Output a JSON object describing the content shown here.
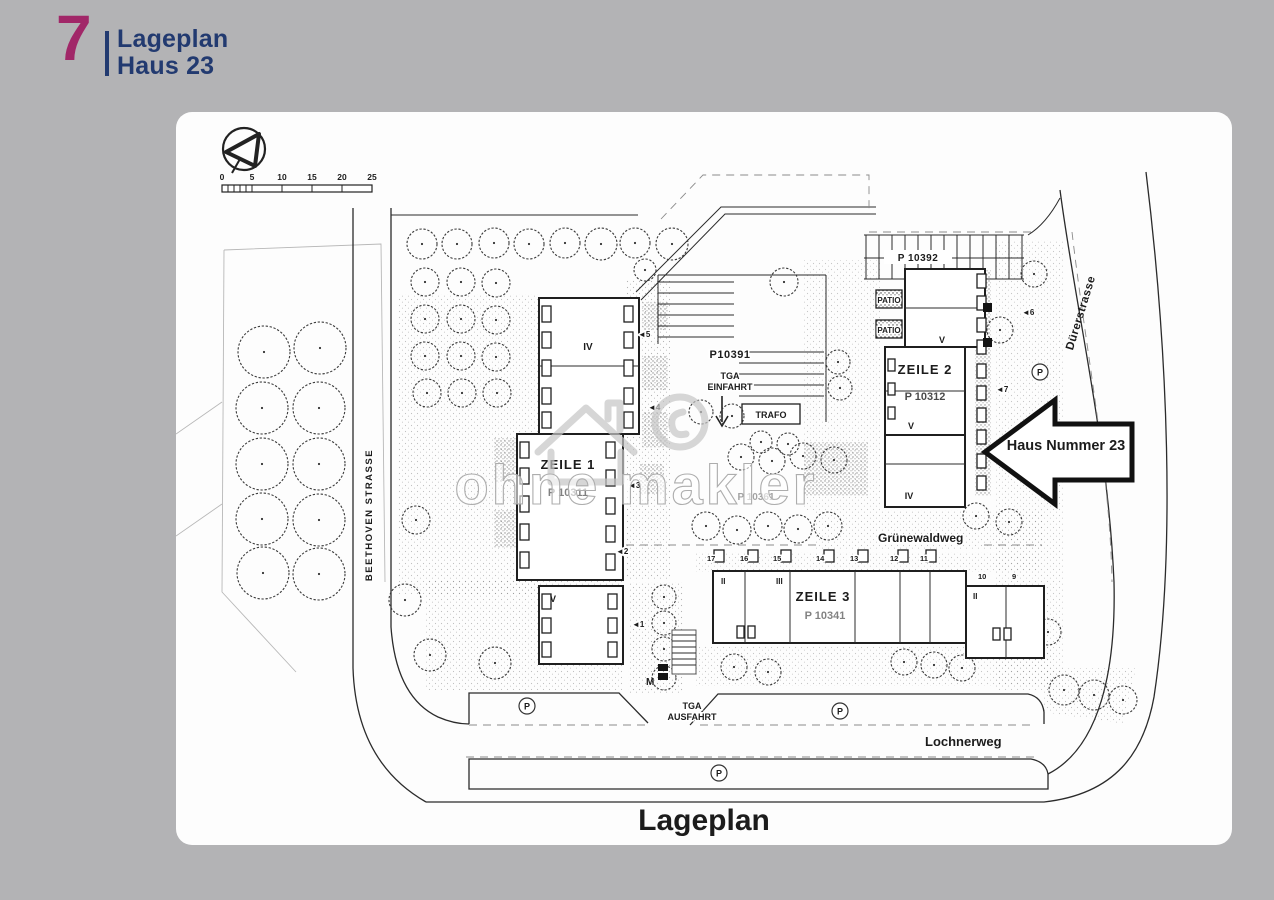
{
  "page": {
    "background": "#b3b3b5",
    "card_background": "#fdfdfd"
  },
  "header": {
    "number": "7",
    "title_line1": "Lageplan",
    "title_line2": "Haus 23",
    "number_color": "#a12768",
    "title_color": "#223a70"
  },
  "plan": {
    "caption": "Lageplan",
    "watermark_text": "ohne makler",
    "arrow_label": "Haus Nummer 23",
    "scale_ticks": [
      "0",
      "5",
      "10",
      "15",
      "20",
      "25"
    ],
    "streets": {
      "left": "BEETHOVEN STRASSE",
      "right": "Dürerstrasse",
      "bottom": "Lochnerweg",
      "inner": "Grünewaldweg"
    },
    "buildings": {
      "zeile1": "ZEILE 1",
      "zeile1_parcel": "P 10311",
      "zeile2": "ZEILE 2",
      "zeile2_parcel": "P 10312",
      "zeile3": "ZEILE 3",
      "zeile3_parcel": "P 10341"
    },
    "parcels": {
      "p10391": "P10391",
      "p10392": "P 10392",
      "p10361": "P 10361"
    },
    "labels": {
      "trafo": "TRAFO",
      "tga": "TGA",
      "einfahrt": "EINFAHRT",
      "ausfahrt": "AUSFAHRT",
      "patio": "PATIO",
      "parking": "P",
      "floor_iv": "IV",
      "floor_v": "V",
      "floor_ii": "II",
      "floor_iii": "III",
      "m": "M"
    },
    "house_numbers": [
      "17",
      "16",
      "15",
      "14",
      "13",
      "12",
      "11",
      "10",
      "9"
    ],
    "markers": {
      "m1": "◄1",
      "m2": "◄2",
      "m3": "◄3",
      "m4": "◄4",
      "m5": "◄5",
      "m6": "◄6",
      "m7": "◄7"
    }
  }
}
